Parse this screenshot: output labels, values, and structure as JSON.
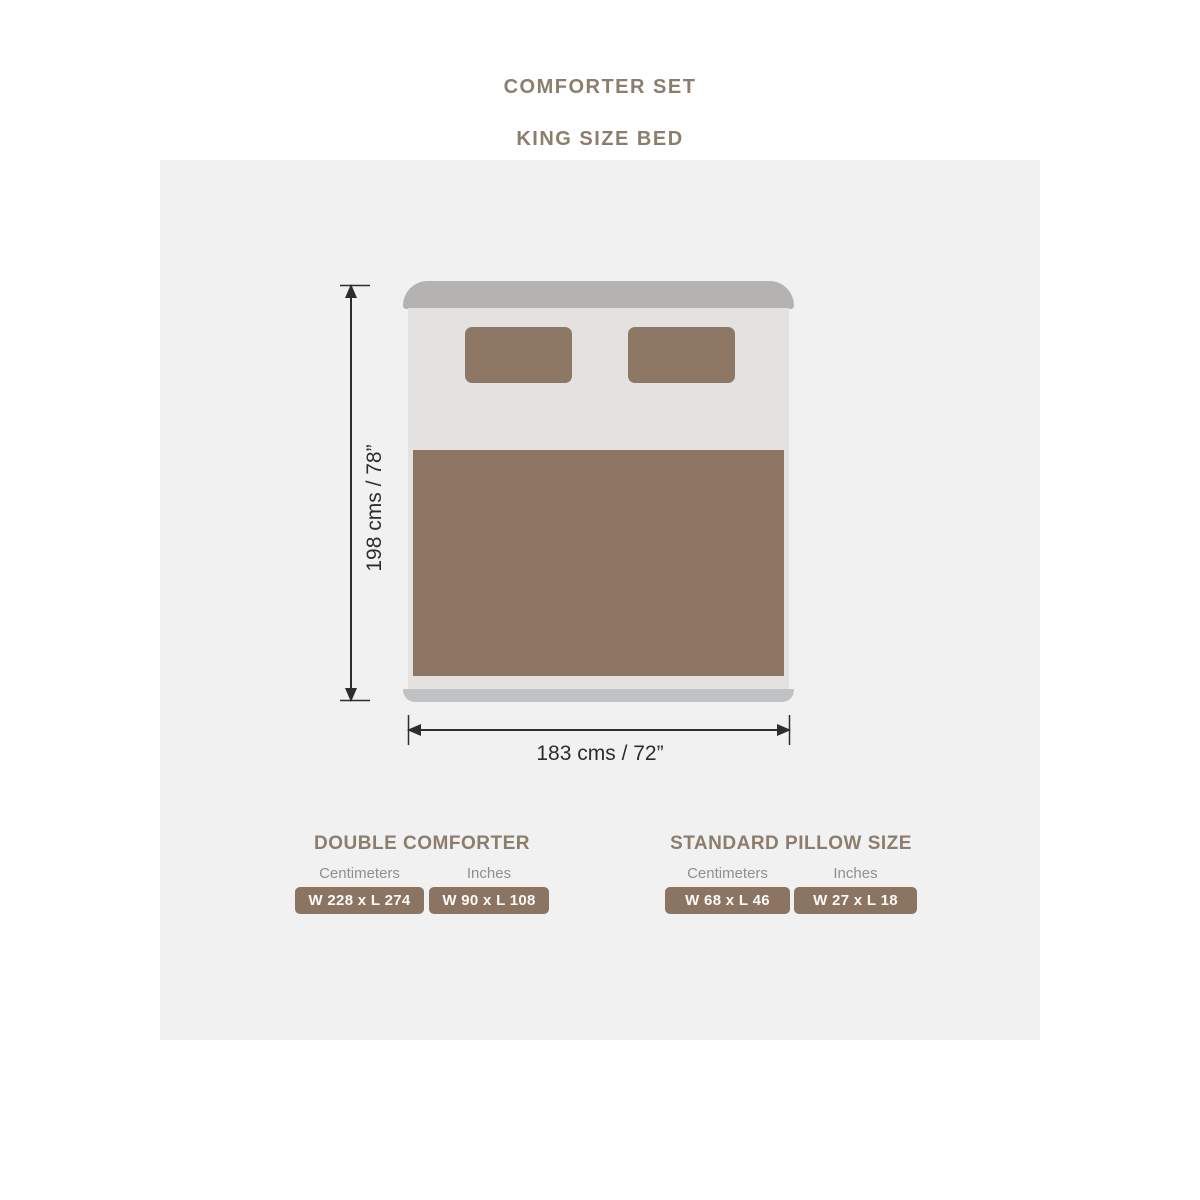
{
  "header": {
    "title": "COMFORTER SET",
    "subtitle": "KING SIZE BED"
  },
  "diagram": {
    "bed_height_label": "198 cms / 78”",
    "bed_width_label": "183 cms / 72”"
  },
  "sections": [
    {
      "heading": "DOUBLE COMFORTER",
      "columns": [
        {
          "label": "Centimeters",
          "value": "W 228 x L 274"
        },
        {
          "label": "Inches",
          "value": "W 90 x L 108"
        }
      ]
    },
    {
      "heading": "STANDARD PILLOW SIZE",
      "columns": [
        {
          "label": "Centimeters",
          "value": "W 68 x L 46"
        },
        {
          "label": "Inches",
          "value": "W 27 x L 18"
        }
      ]
    }
  ],
  "colors": {
    "heading_brown": "#8C7D6C",
    "badge_brown": "#8C7462",
    "comforter_brown": "#8C7663",
    "pillow_brown": "#8D7765",
    "headboard_gray": "#B5B3B1",
    "sheet_gray": "#E3E2E0",
    "bed_footer_gray": "#C0C2C4",
    "panel_bg": "#F1F1F1",
    "label_gray": "#8F8F8F",
    "dimension_ink": "#2D2D2D"
  }
}
